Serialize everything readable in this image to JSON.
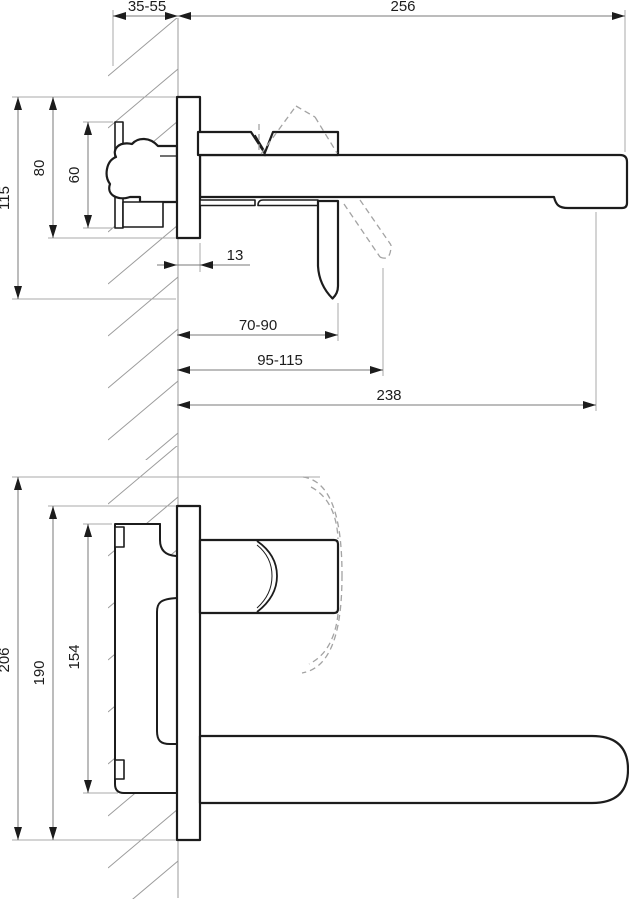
{
  "drawing": {
    "background": "#ffffff",
    "outline_color": "#1c1c1c",
    "dimension_line_color": "#787878",
    "hatch_color": "#9b9b9b",
    "side_view": {
      "dims": {
        "wall_depth_range": "35-55",
        "spout_length": "256",
        "overall_height": "115",
        "plate_height": "80",
        "body_height": "60",
        "plate_thickness": "13",
        "handle_reach_closed": "70-90",
        "handle_reach_open": "95-115",
        "spout_reach": "238"
      }
    },
    "plan_view": {
      "dims": {
        "overall_width": "206",
        "plate_width": "190",
        "body_width": "154"
      }
    }
  }
}
